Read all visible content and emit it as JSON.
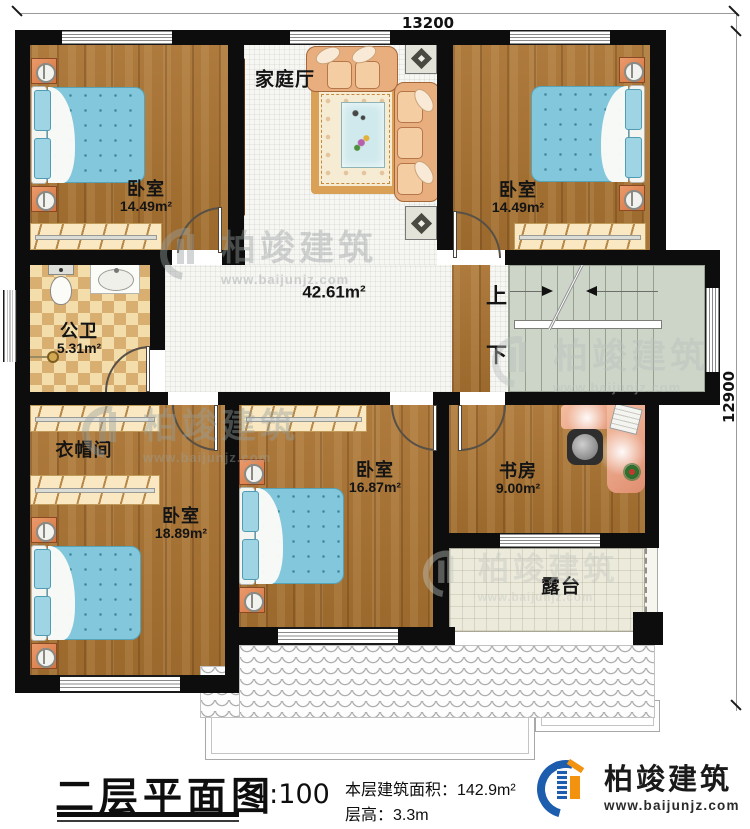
{
  "plan": {
    "dimensions": {
      "top": "13200",
      "right": "12900"
    },
    "stairs": {
      "up": "上",
      "down": "下"
    },
    "rooms": {
      "family_hall": {
        "name": "家庭厅"
      },
      "hall": {
        "area": "42.61m²"
      },
      "bedroom_top_left": {
        "name": "卧室",
        "area": "14.49m²"
      },
      "bedroom_top_right": {
        "name": "卧室",
        "area": "14.49m²"
      },
      "bathroom": {
        "name": "公卫",
        "area": "5.31m²"
      },
      "cloakroom": {
        "name": "衣帽间"
      },
      "bedroom_bottom_left": {
        "name": "卧室",
        "area": "18.89m²"
      },
      "bedroom_bottom_middle": {
        "name": "卧室",
        "area": "16.87m²"
      },
      "study": {
        "name": "书房",
        "area": "9.00m²"
      },
      "terrace": {
        "name": "露台"
      }
    }
  },
  "title_block": {
    "title": "二层平面图",
    "scale": "1:100",
    "area_line": "本层建筑面积：142.9m²",
    "floor_height_line": "层高：3.3m"
  },
  "brand": {
    "name": "柏竣建筑",
    "url": "www.baijunjz.com"
  },
  "watermark": {
    "name": "柏竣建筑",
    "url": "www.baijunjz.com"
  },
  "colors": {
    "wall": "#0d0d0d",
    "wood_floor": "#a97231",
    "tile_floor": "#f6f6f3",
    "bathroom_tile": "#f3ddab",
    "stair": "#ccd5c8",
    "terrace": "#eceadb",
    "bed": "#82c7db",
    "brand_blue": "#1d5dae",
    "brand_orange": "#f2920f"
  }
}
